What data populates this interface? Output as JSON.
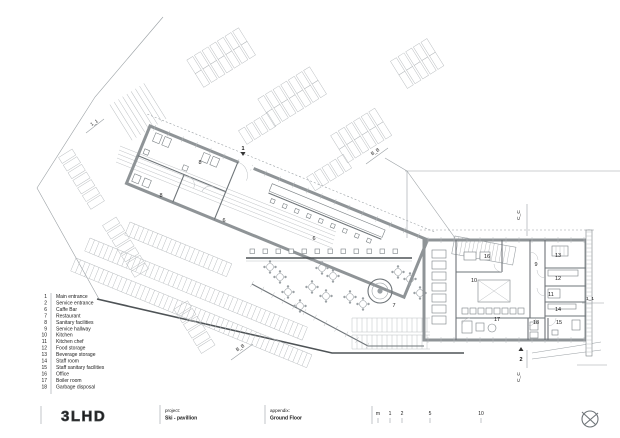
{
  "drawing": {
    "type": "architectural floor plan",
    "logo": "3LHD",
    "project_label": "project:",
    "project_value": "Ski - pavillion",
    "appendix_label": "appendix:",
    "appendix_value": "Ground Floor"
  },
  "legend": {
    "items": [
      {
        "num": "1",
        "label": "Main entrance"
      },
      {
        "num": "2",
        "label": "Service entrance"
      },
      {
        "num": "6",
        "label": "Caffe Bar"
      },
      {
        "num": "7",
        "label": "Restaurant"
      },
      {
        "num": "8",
        "label": "Sanitary facilities"
      },
      {
        "num": "9",
        "label": "Service hallway"
      },
      {
        "num": "10",
        "label": "Kitchen"
      },
      {
        "num": "11",
        "label": "Kitchen chef"
      },
      {
        "num": "12",
        "label": "Food storage"
      },
      {
        "num": "13",
        "label": "Beverage storage"
      },
      {
        "num": "14",
        "label": "Staff room"
      },
      {
        "num": "15",
        "label": "Staff sanitary facilities"
      },
      {
        "num": "16",
        "label": "Office"
      },
      {
        "num": "17",
        "label": "Boiler room"
      },
      {
        "num": "18",
        "label": "Garbage disposal"
      }
    ]
  },
  "plan": {
    "room_labels": [
      {
        "t": "8",
        "x": 200,
        "y": 164
      },
      {
        "t": "8",
        "x": 161,
        "y": 197
      },
      {
        "t": "6",
        "x": 224,
        "y": 222
      },
      {
        "t": "6",
        "x": 314,
        "y": 240
      },
      {
        "t": "7",
        "x": 394,
        "y": 307
      },
      {
        "t": "16",
        "x": 487,
        "y": 258
      },
      {
        "t": "9",
        "x": 536,
        "y": 266
      },
      {
        "t": "13",
        "x": 558,
        "y": 257
      },
      {
        "t": "12",
        "x": 558,
        "y": 280
      },
      {
        "t": "11",
        "x": 551,
        "y": 296
      },
      {
        "t": "10",
        "x": 474,
        "y": 282
      },
      {
        "t": "14",
        "x": 558,
        "y": 311
      },
      {
        "t": "15",
        "x": 559,
        "y": 324
      },
      {
        "t": "18",
        "x": 536,
        "y": 324
      },
      {
        "t": "17",
        "x": 497,
        "y": 321
      }
    ],
    "entrance_markers": [
      {
        "t": "1",
        "x": 243,
        "y": 150,
        "dir": "down"
      },
      {
        "t": "2",
        "x": 521,
        "y": 361,
        "dir": "up"
      }
    ],
    "section_markers": [
      {
        "t": "1_1",
        "x": 95,
        "y": 124,
        "r": -33
      },
      {
        "t": "B_B",
        "x": 376,
        "y": 153,
        "r": -33
      },
      {
        "t": "B_B",
        "x": 241,
        "y": 349,
        "r": -33
      },
      {
        "t": "C_C",
        "x": 520,
        "y": 215,
        "r": -90
      },
      {
        "t": "C_C",
        "x": 520,
        "y": 377,
        "r": -90
      },
      {
        "t": "1_1",
        "x": 590,
        "y": 300,
        "r": 0
      }
    ]
  },
  "scalebar": {
    "marks": [
      {
        "t": "m",
        "x": 378
      },
      {
        "t": "1",
        "x": 390
      },
      {
        "t": "2",
        "x": 402
      },
      {
        "t": "5",
        "x": 430
      },
      {
        "t": "10",
        "x": 481
      }
    ]
  },
  "colors": {
    "wall": "#8f9497",
    "line": "#9aa0a4",
    "dark_line": "#4e5356",
    "text": "#1a1a1a",
    "background": "#ffffff"
  }
}
